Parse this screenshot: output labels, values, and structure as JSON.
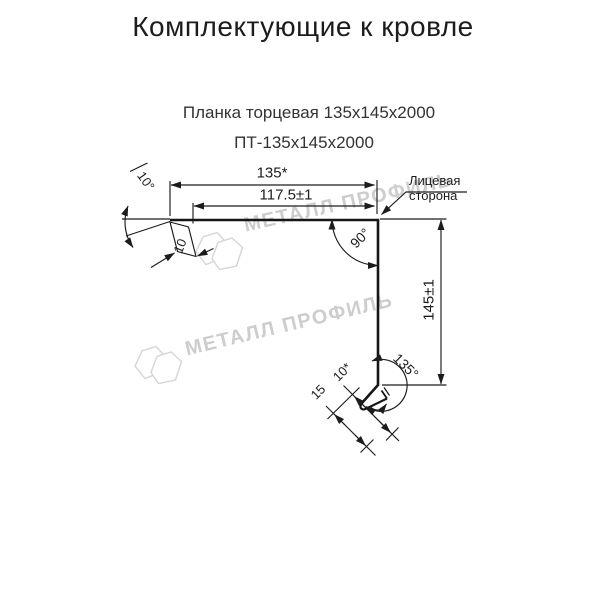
{
  "page": {
    "title": "Комплектующие к кровле",
    "subtitle": "Планка торцевая 135х145х2000",
    "model": "ПТ-135х145х2000"
  },
  "watermark": {
    "text": "МЕТАЛЛ ПРОФИЛЬ",
    "color": "#cdcdcd"
  },
  "face_label": {
    "line1": "Лицевая",
    "line2": "сторона"
  },
  "dimensions": {
    "width_total": "135*",
    "width_inner": "117.5±1",
    "height": "145±1",
    "corner_angle": "90°",
    "top_hem_angle": "10°",
    "top_hem_width": "10",
    "bottom_bend_angle": "135°",
    "bottom_hem_width": "10*",
    "bottom_fold_length": "15"
  },
  "colors": {
    "line": "#1c1c1c",
    "text": "#1f1f1f",
    "watermark": "#cdcdcd",
    "background": "#ffffff"
  }
}
